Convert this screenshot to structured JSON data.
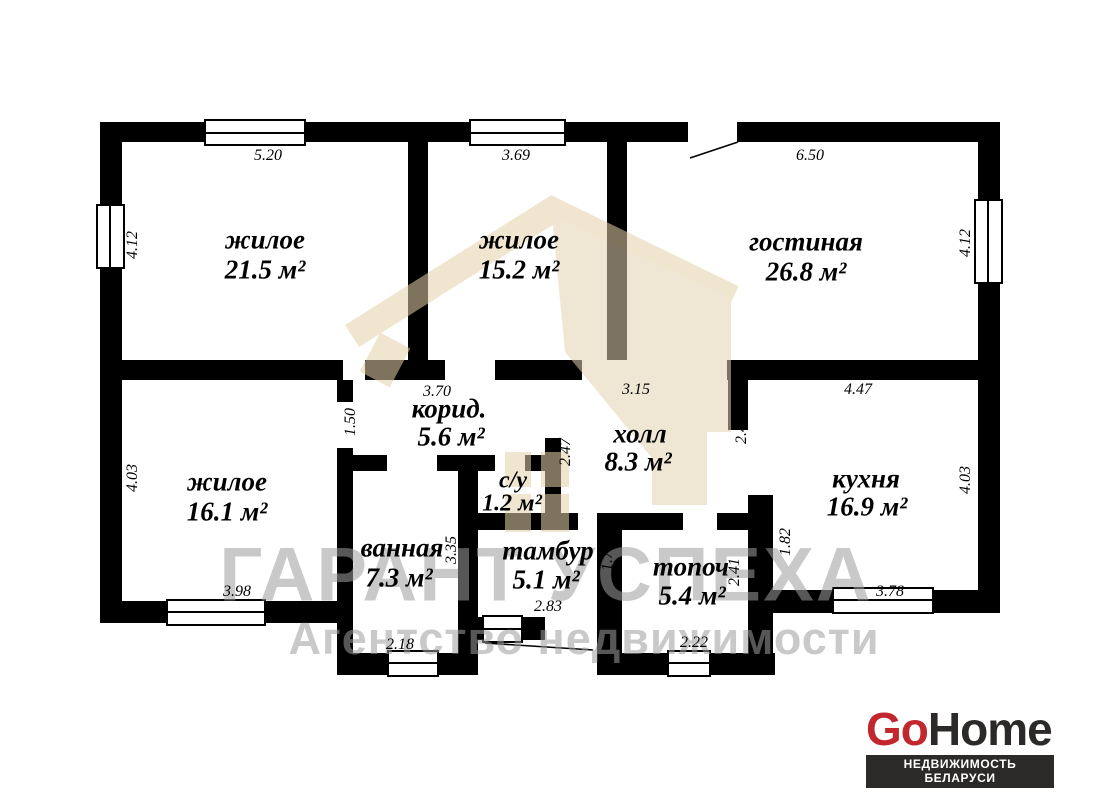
{
  "plan": {
    "wall_color": "#000000",
    "floor_color": "#ffffff",
    "rooms": [
      {
        "name": "жилое",
        "area": "21.5 м²"
      },
      {
        "name": "жилое",
        "area": "15.2 м²"
      },
      {
        "name": "гостиная",
        "area": "26.8 м²"
      },
      {
        "name": "жилое",
        "area": "16.1 м²"
      },
      {
        "name": "корид.",
        "area": "5.6 м²"
      },
      {
        "name": "холл",
        "area": "8.3 м²"
      },
      {
        "name": "с/у",
        "area": "1.2 м²"
      },
      {
        "name": "ванная",
        "area": "7.3 м²"
      },
      {
        "name": "тамбур",
        "area": "5.1 м²"
      },
      {
        "name": "топоч",
        "area": "5.4 м²"
      },
      {
        "name": "кухня",
        "area": "16.9 м²"
      }
    ],
    "dims": [
      "5.20",
      "3.69",
      "6.50",
      "4.12",
      "4.12",
      "4.12",
      "3.70",
      "3.15",
      "4.47",
      "1.50",
      "2.47",
      "2.46",
      "4.03",
      "4.03",
      "3.35",
      "1.78",
      "2.41",
      "1.82",
      "3.98",
      "2.18",
      "2.83",
      "2.22",
      "3.78"
    ]
  },
  "watermark": {
    "agency_name": "ГАРАНТ УСПЕХА",
    "agency_subtitle": "Агентство недвижимости",
    "text_color": "#9e9e9e",
    "house_color": "#e5d1a9"
  },
  "logo": {
    "brand_go": "Go",
    "brand_home": "Home",
    "tagline": "НЕДВИЖИМОСТЬ БЕЛАРУСИ",
    "go_color": "#c1272d",
    "home_color": "#2b2a29",
    "bar_bg": "#2b2a29",
    "bar_text_color": "#ffffff"
  }
}
